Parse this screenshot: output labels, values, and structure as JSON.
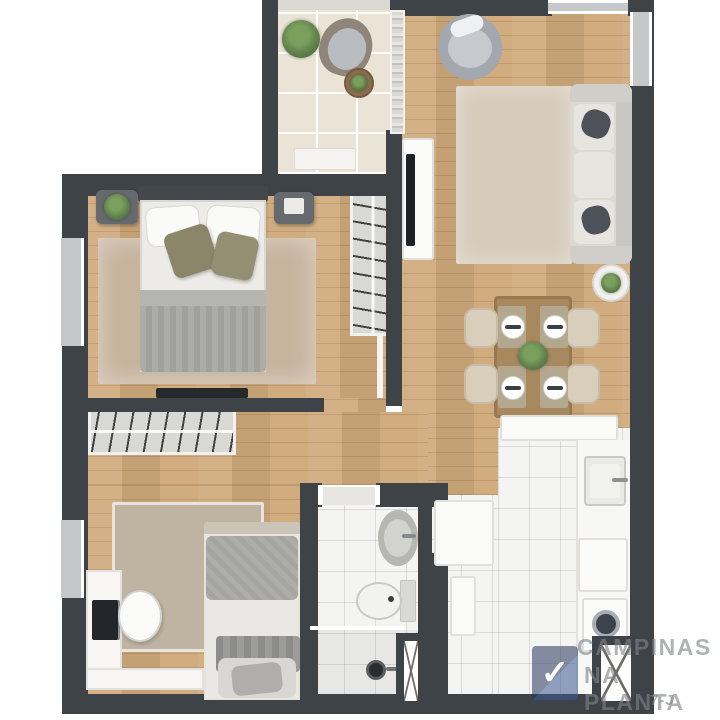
{
  "watermark": {
    "brand_line1": "CAMPINAS",
    "brand_line2": "NA PLANTA",
    "registration_suffix": "7-J",
    "logo_check_glyph": "✓",
    "text_color": "#82868a",
    "logo_color": "#27375f"
  },
  "palette": {
    "wall": "#3e4348",
    "wood": "#cfa97b",
    "tileBeige": "#eae3d6",
    "tileWhite": "#f4f4f3",
    "windowGray": "#c5c7c9",
    "hangerBg": "#d8d8d5",
    "applianceWhite": "#fbfbfa",
    "chairBeige": "#d9cebc",
    "plantGreen": "#5f7f4c",
    "rugMaster": "#c7b49f",
    "rugLiving": "#d6ccbc",
    "rugBedroom2": "#bfb3a2",
    "sofaGray": "#dbd9d4",
    "cushionDark": "#4c5257",
    "duvetGray": "#a0a19d",
    "oliveCushion": "#8b8569",
    "headboardDark": "#44484c",
    "nightstandGray": "#66696d",
    "tableWood": "#a8895f",
    "monitorDark": "#23262a",
    "logoNavy": "#27375f"
  },
  "plan": {
    "type": "apartment-floor-plan-top-view",
    "rooms": [
      {
        "name": "balcony",
        "floor": "beige-tile",
        "items": [
          "potted-plant",
          "wicker-lounge-chair",
          "round-coffee-table",
          "white-bench",
          "sliding-glass-door"
        ]
      },
      {
        "name": "living-room",
        "floor": "wood",
        "items": [
          "round-armchair",
          "area-rug",
          "three-seat-sofa",
          "two-dark-cushions",
          "side-table-with-plant",
          "tv-panel"
        ]
      },
      {
        "name": "dining-area",
        "floor": "wood",
        "items": [
          "wood-table",
          "four-chairs",
          "four-place-settings",
          "centerpiece-plant"
        ]
      },
      {
        "name": "kitchen",
        "floor": "white-tile",
        "items": [
          "upper-cabinet",
          "refrigerator",
          "base-cabinet",
          "counter",
          "sink",
          "four-burner-stove",
          "washing-machine",
          "service-duct"
        ]
      },
      {
        "name": "master-bedroom",
        "floor": "wood",
        "items": [
          "double-bed",
          "two-nightstands",
          "plant",
          "area-rug",
          "wardrobe-with-hangers",
          "wall-tv",
          "window"
        ]
      },
      {
        "name": "hallway",
        "floor": "wood",
        "items": [
          "closet-with-hangers"
        ]
      },
      {
        "name": "bedroom-2",
        "floor": "wood",
        "items": [
          "single-bed",
          "area-rug",
          "l-shaped-desk",
          "monitor",
          "desk-chair",
          "window"
        ]
      },
      {
        "name": "bathroom",
        "floor": "white-tile",
        "items": [
          "oval-sink",
          "toilet",
          "shower-with-drain",
          "glass-partition",
          "service-duct"
        ]
      }
    ]
  }
}
